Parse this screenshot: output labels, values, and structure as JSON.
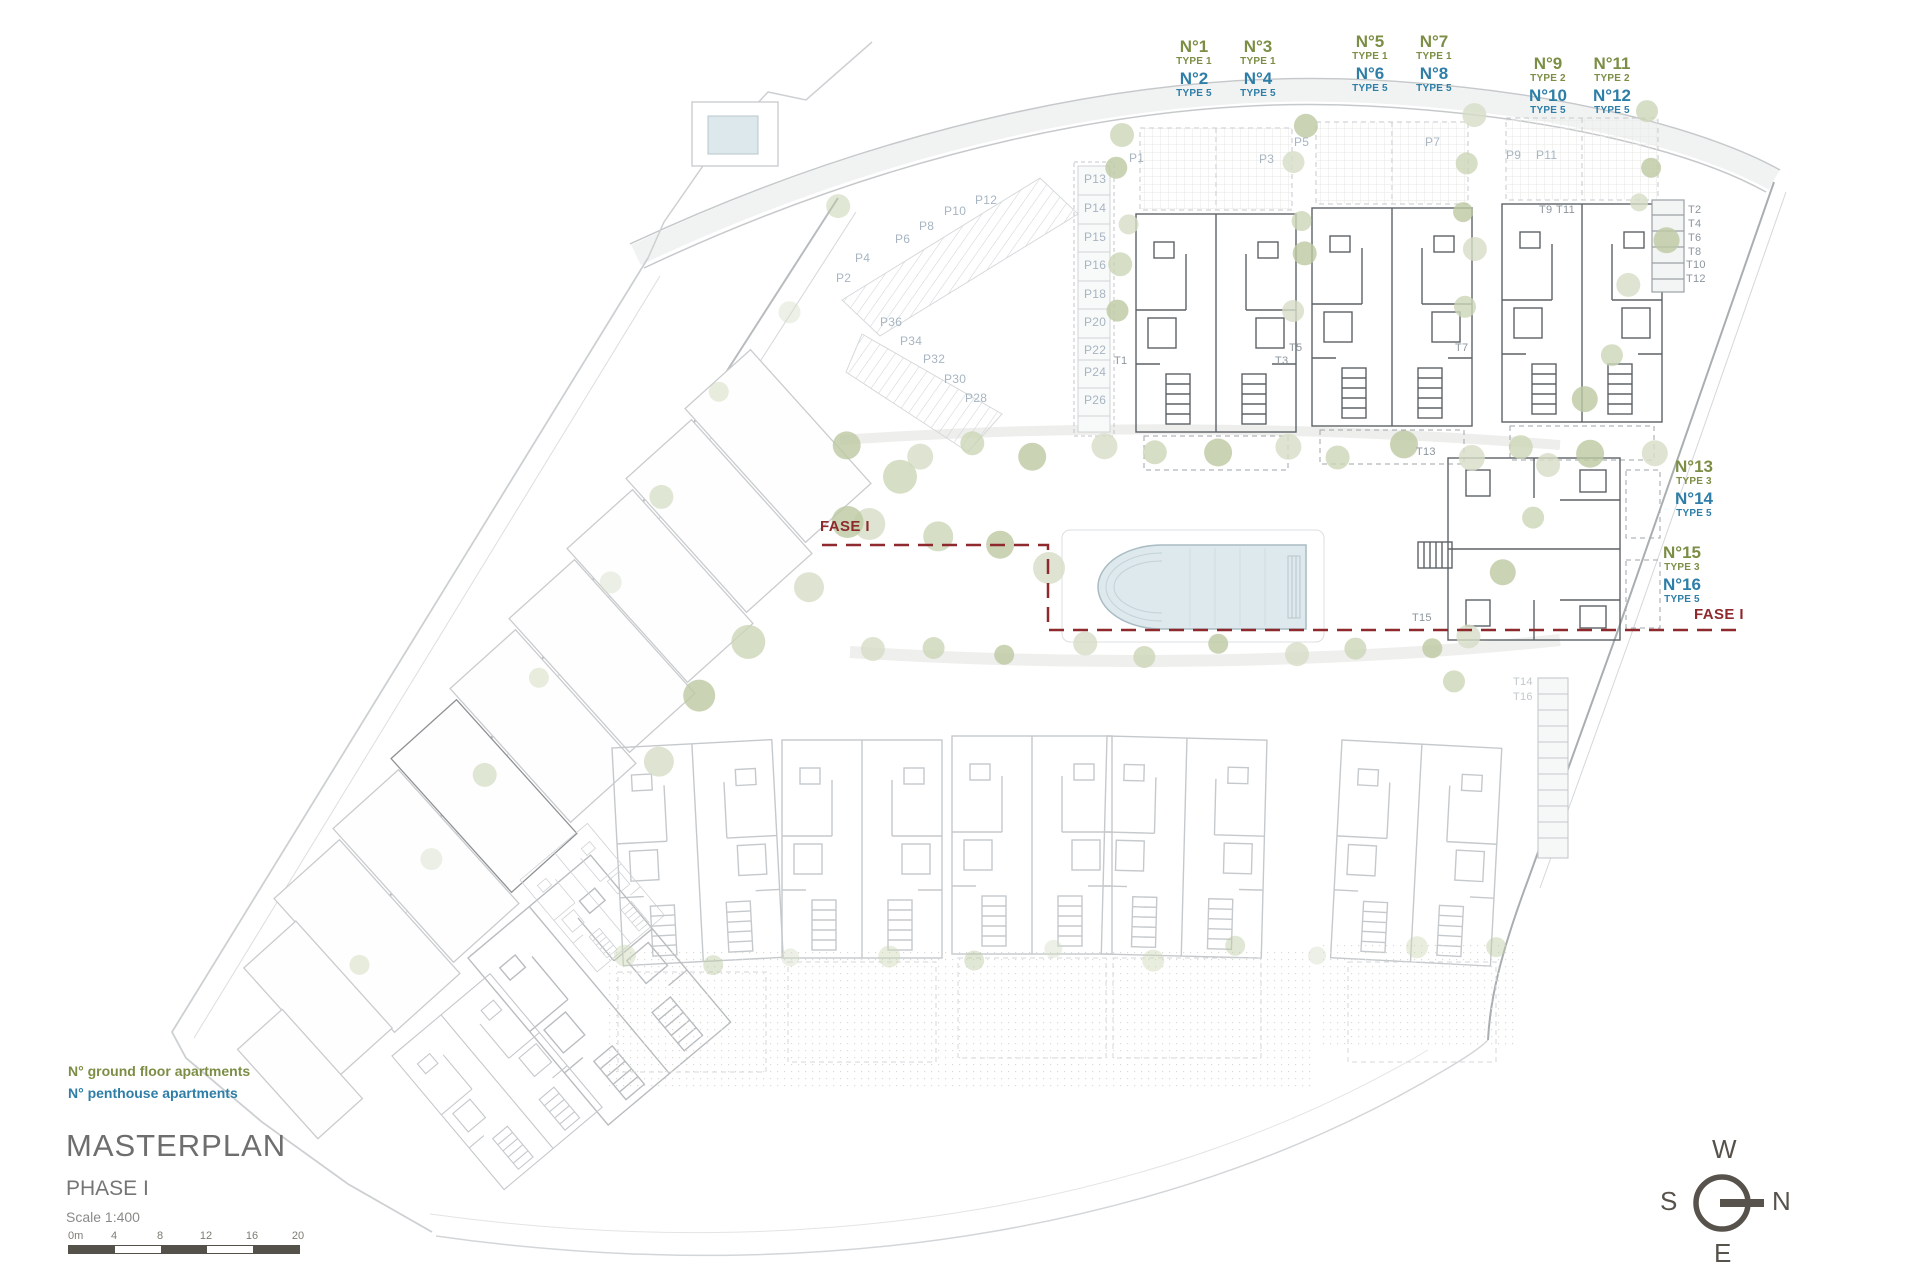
{
  "title_block": {
    "title": "MASTERPLAN",
    "phase": "PHASE I",
    "scale": "Scale 1:400"
  },
  "legend": [
    {
      "text": "N° ground floor apartments",
      "color": "green"
    },
    {
      "text": "N° penthouse apartments",
      "color": "blue"
    }
  ],
  "colors": {
    "ground": "#7c8e45",
    "penthouse": "#2e7ea7",
    "phase_boundary": "#8e2a2e",
    "title_gray": "#6e6e6e"
  },
  "scale_bar": {
    "ticks": [
      "0m",
      "4",
      "8",
      "12",
      "16",
      "20"
    ]
  },
  "compass": {
    "top": "W",
    "right": "N",
    "bottom": "E",
    "left": "S"
  },
  "phase_labels": [
    {
      "text": "FASE I",
      "x": 820,
      "y": 518
    },
    {
      "text": "FASE I",
      "x": 1694,
      "y": 606
    }
  ],
  "apartment_groups": [
    {
      "x": 1166,
      "y": 38,
      "layout": "grid",
      "cells": [
        {
          "no": "N°1",
          "type": "TYPE 1",
          "color": "green"
        },
        {
          "no": "N°3",
          "type": "TYPE 1",
          "color": "green"
        },
        {
          "no": "N°2",
          "type": "TYPE 5",
          "color": "blue"
        },
        {
          "no": "N°4",
          "type": "TYPE 5",
          "color": "blue"
        }
      ]
    },
    {
      "x": 1342,
      "y": 33,
      "layout": "grid",
      "cells": [
        {
          "no": "N°5",
          "type": "TYPE 1",
          "color": "green"
        },
        {
          "no": "N°7",
          "type": "TYPE 1",
          "color": "green"
        },
        {
          "no": "N°6",
          "type": "TYPE 5",
          "color": "blue"
        },
        {
          "no": "N°8",
          "type": "TYPE 5",
          "color": "blue"
        }
      ]
    },
    {
      "x": 1520,
      "y": 55,
      "layout": "grid",
      "cells": [
        {
          "no": "N°9",
          "type": "TYPE 2",
          "color": "green"
        },
        {
          "no": "N°11",
          "type": "TYPE 2",
          "color": "green"
        },
        {
          "no": "N°10",
          "type": "TYPE 5",
          "color": "blue"
        },
        {
          "no": "N°12",
          "type": "TYPE 5",
          "color": "blue"
        }
      ]
    },
    {
      "x": 1662,
      "y": 458,
      "layout": "column",
      "cells": [
        {
          "no": "N°13",
          "type": "TYPE 3",
          "color": "green"
        },
        {
          "no": "N°14",
          "type": "TYPE 5",
          "color": "blue"
        }
      ]
    },
    {
      "x": 1650,
      "y": 544,
      "layout": "column",
      "cells": [
        {
          "no": "N°15",
          "type": "TYPE 3",
          "color": "green"
        },
        {
          "no": "N°16",
          "type": "TYPE 5",
          "color": "blue"
        }
      ]
    }
  ],
  "parking_labels": [
    {
      "t": "P1",
      "x": 1129,
      "y": 151
    },
    {
      "t": "P3",
      "x": 1259,
      "y": 152
    },
    {
      "t": "P5",
      "x": 1294,
      "y": 135
    },
    {
      "t": "P7",
      "x": 1425,
      "y": 135
    },
    {
      "t": "P9",
      "x": 1506,
      "y": 148
    },
    {
      "t": "P11",
      "x": 1536,
      "y": 148
    },
    {
      "t": "P13",
      "x": 1084,
      "y": 172
    },
    {
      "t": "P14",
      "x": 1084,
      "y": 201
    },
    {
      "t": "P15",
      "x": 1084,
      "y": 230
    },
    {
      "t": "P16",
      "x": 1084,
      "y": 258
    },
    {
      "t": "P18",
      "x": 1084,
      "y": 287
    },
    {
      "t": "P20",
      "x": 1084,
      "y": 315
    },
    {
      "t": "P22",
      "x": 1084,
      "y": 343
    },
    {
      "t": "P24",
      "x": 1084,
      "y": 365
    },
    {
      "t": "P26",
      "x": 1084,
      "y": 393
    },
    {
      "t": "P2",
      "x": 836,
      "y": 271
    },
    {
      "t": "P4",
      "x": 855,
      "y": 251
    },
    {
      "t": "P6",
      "x": 895,
      "y": 232
    },
    {
      "t": "P8",
      "x": 919,
      "y": 219
    },
    {
      "t": "P10",
      "x": 944,
      "y": 204
    },
    {
      "t": "P12",
      "x": 975,
      "y": 193
    },
    {
      "t": "P36",
      "x": 880,
      "y": 315
    },
    {
      "t": "P34",
      "x": 900,
      "y": 334
    },
    {
      "t": "P32",
      "x": 923,
      "y": 352
    },
    {
      "t": "P30",
      "x": 944,
      "y": 372
    },
    {
      "t": "P28",
      "x": 965,
      "y": 391
    }
  ],
  "stair_labels": [
    {
      "t": "T1",
      "x": 1114,
      "y": 355
    },
    {
      "t": "T3",
      "x": 1275,
      "y": 355
    },
    {
      "t": "T5",
      "x": 1289,
      "y": 342
    },
    {
      "t": "T7",
      "x": 1455,
      "y": 342
    },
    {
      "t": "T9",
      "x": 1539,
      "y": 204
    },
    {
      "t": "T11",
      "x": 1556,
      "y": 204
    },
    {
      "t": "T2",
      "x": 1688,
      "y": 204
    },
    {
      "t": "T4",
      "x": 1688,
      "y": 218
    },
    {
      "t": "T6",
      "x": 1688,
      "y": 232
    },
    {
      "t": "T8",
      "x": 1688,
      "y": 246
    },
    {
      "t": "T10",
      "x": 1686,
      "y": 259
    },
    {
      "t": "T12",
      "x": 1686,
      "y": 273
    },
    {
      "t": "T13",
      "x": 1416,
      "y": 446
    },
    {
      "t": "T15",
      "x": 1412,
      "y": 612
    },
    {
      "t": "T14",
      "x": 1513,
      "y": 676,
      "f": true
    },
    {
      "t": "T16",
      "x": 1513,
      "y": 691,
      "f": true
    }
  ]
}
